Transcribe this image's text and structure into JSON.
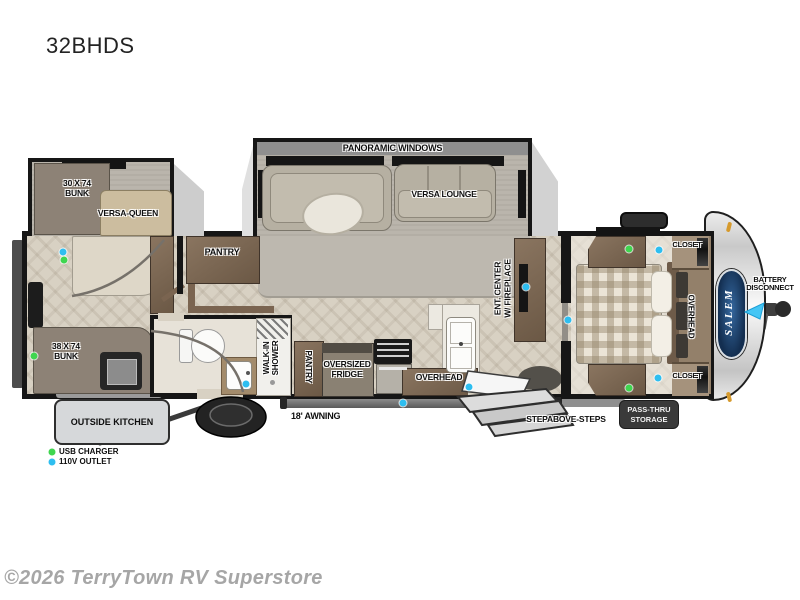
{
  "title": "32BHDS",
  "watermark": "©2026 TerryTown RV Superstore",
  "brand_badge": "SALEM",
  "legend": {
    "usb_label": "USB CHARGER",
    "outlet_label": "110V OUTLET"
  },
  "labels": {
    "panoramic_windows": "PANORAMIC WINDOWS",
    "versa_lounge": "VERSA LOUNGE",
    "versa_queen": "VERSA-QUEEN",
    "bunk_30": "30 X 74\nBUNK",
    "bunk_38": "38 X 74\nBUNK",
    "pantry_hall": "PANTRY",
    "pantry_kitchen": "PANTRY",
    "walk_in_shower": "WALK-IN\nSHOWER",
    "oversized_fridge": "OVERSIZED\nFRIDGE",
    "overhead_kitchen": "OVERHEAD",
    "ent_center": "ENT. CENTER\nW/ FIREPLACE",
    "closet_front_top": "CLOSET",
    "closet_front_bottom": "CLOSET",
    "overhead_bedroom": "OVERHEAD",
    "outside_kitchen": "OUTSIDE KITCHEN",
    "awning": "18' AWNING",
    "stepabove_steps": "STEPABOVE-STEPS",
    "pass_thru": "PASS-THRU\nSTORAGE",
    "battery_disconnect": "BATTERY\nDISCONNECT"
  },
  "colors": {
    "usb_dot": "#3fd64f",
    "outlet_dot": "#2ebef0",
    "wall": "#161616",
    "floor_wood": "#d8d1c3",
    "carpet": "#bab5ac",
    "cabinet_wood": "#7d6a55",
    "badge_dark": "#3a3a3a",
    "salem_navy": "#14345b",
    "arrow_cyan": "#45c6f5"
  },
  "dots": [
    {
      "type": "outlet",
      "x": 63,
      "y": 252
    },
    {
      "type": "usb",
      "x": 64,
      "y": 260
    },
    {
      "type": "usb",
      "x": 34,
      "y": 356
    },
    {
      "type": "outlet",
      "x": 246,
      "y": 384
    },
    {
      "type": "outlet",
      "x": 403,
      "y": 403
    },
    {
      "type": "outlet",
      "x": 469,
      "y": 387
    },
    {
      "type": "outlet",
      "x": 526,
      "y": 287
    },
    {
      "type": "usb",
      "x": 629,
      "y": 249
    },
    {
      "type": "outlet",
      "x": 659,
      "y": 250
    },
    {
      "type": "outlet",
      "x": 568,
      "y": 320
    },
    {
      "type": "outlet",
      "x": 658,
      "y": 378
    },
    {
      "type": "usb",
      "x": 629,
      "y": 388
    }
  ]
}
